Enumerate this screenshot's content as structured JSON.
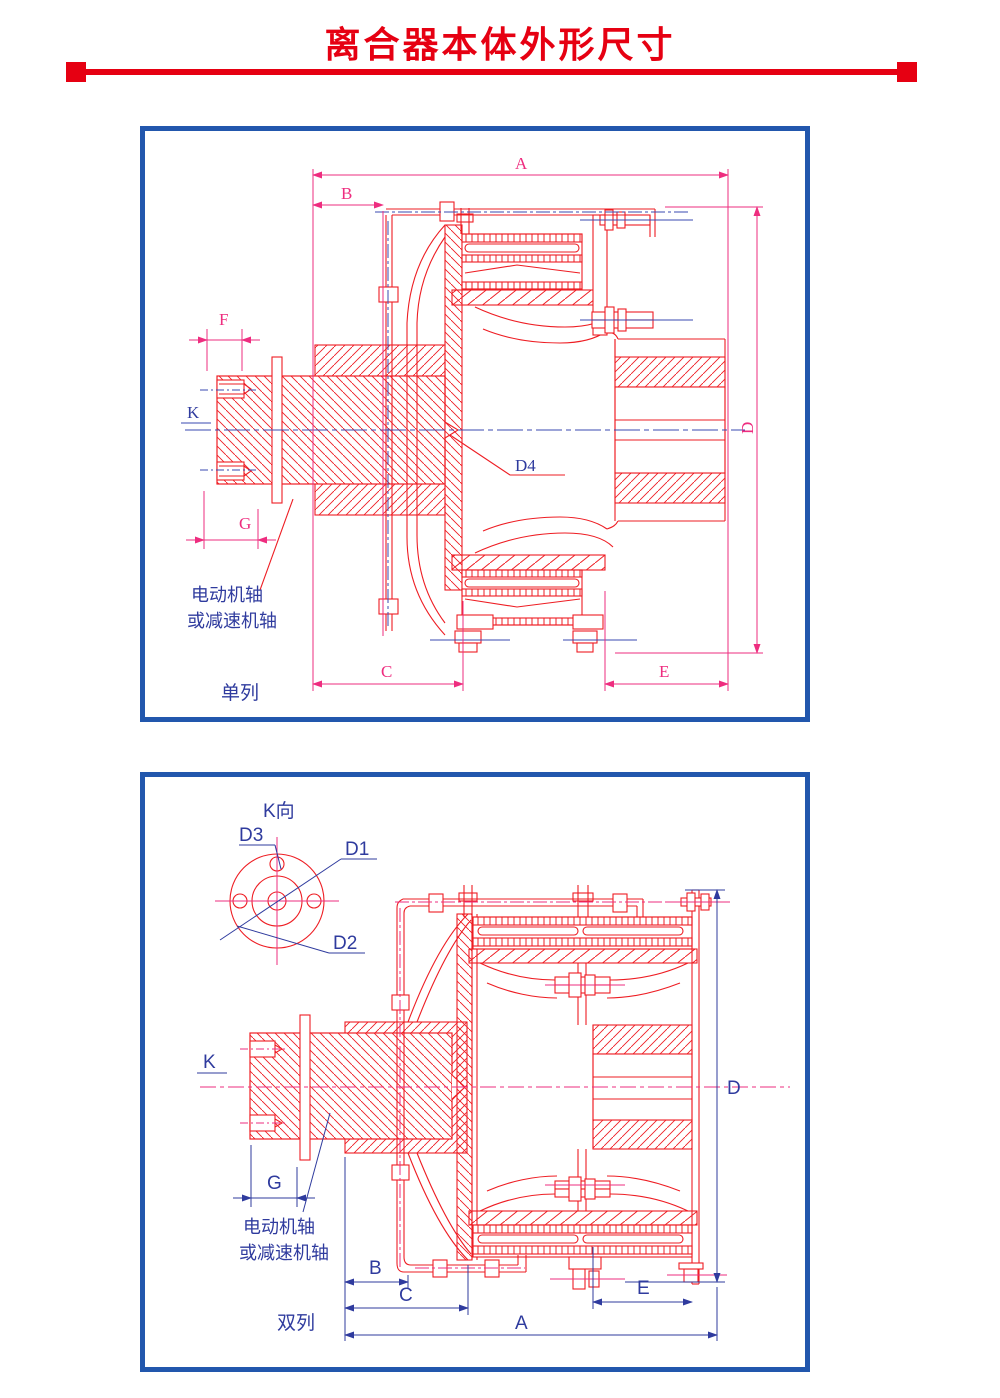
{
  "title": {
    "text": "离合器本体外形尺寸"
  },
  "colors": {
    "title_red": "#e60012",
    "drawing_red": "#ee1d23",
    "dimension_magenta": "#ee2d7f",
    "annotation_blue": "#2f3b9e",
    "panel_border_blue": "#2257ad"
  },
  "top_panel": {
    "caption": "单列",
    "note_line1": "电动机轴",
    "note_line2": "或减速机轴",
    "labels": {
      "A": "A",
      "B": "B",
      "C": "C",
      "D": "D",
      "E": "E",
      "F": "F",
      "G": "G",
      "K": "K",
      "D4": "D4"
    }
  },
  "bottom_panel": {
    "view_label": "K向",
    "caption": "双列",
    "note_line1": "电动机轴",
    "note_line2": "或减速机轴",
    "labels": {
      "A": "A",
      "B": "B",
      "C": "C",
      "D": "D",
      "E": "E",
      "G": "G",
      "K": "K",
      "D1": "D1",
      "D2": "D2",
      "D3": "D3"
    }
  }
}
